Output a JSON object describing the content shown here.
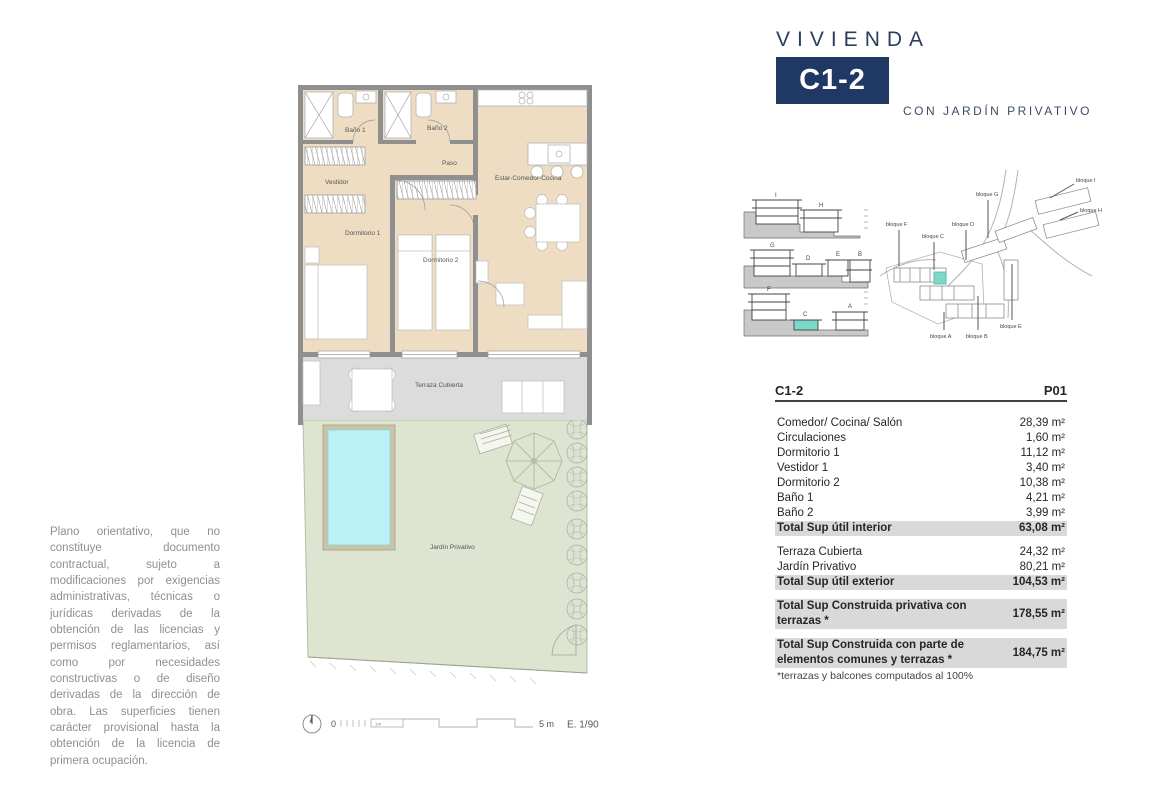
{
  "header": {
    "title": "VIVIENDA",
    "unit_code": "C1-2",
    "subtitle": "CON JARDÍN PRIVATIVO",
    "accent_color": "#1f3864"
  },
  "disclaimer": "Plano orientativo, que no constituye documento contractual, sujeto a modificaciones por exigencias administrativas, técnicas o jurídicas derivadas de la obtención de las licencias y permisos reglamentarios, así como por necesidades constructivas o de diseño derivadas de la dirección de obra. Las superficies tienen carácter provisional hasta la obtención de la licencia de primera ocupación.",
  "floorplan": {
    "labels": {
      "bano1": "Baño 1",
      "bano2": "Baño 2",
      "paso": "Paso",
      "vestidor": "Vestidor",
      "dormitorio1": "Dormitorio 1",
      "dormitorio2": "Dormitorio 2",
      "estar": "Estar-Comedor-Cocina",
      "terraza": "Terraza Cubierta",
      "jardin": "Jardín Privativo"
    },
    "colors": {
      "interior": "#eeddc2",
      "wall": "#8f8f8f",
      "terrace": "#dcdcdc",
      "garden": "#dde4d0",
      "pool": "#baf1f6",
      "highlight": "#7cd8c8"
    }
  },
  "scalebar": {
    "zero": "0",
    "one_m": "1m",
    "five_m": "5 m",
    "scale": "E. 1/90"
  },
  "sections": {
    "rows": [
      {
        "blocks": [
          "I",
          "H"
        ]
      },
      {
        "blocks": [
          "G",
          "D",
          "E",
          "B"
        ]
      },
      {
        "blocks": [
          "F",
          "C",
          "A"
        ]
      }
    ]
  },
  "siteplan": {
    "labels": [
      "bloque F",
      "bloque C",
      "bloque G",
      "bloque D",
      "bloque I",
      "bloque H",
      "bloque A",
      "bloque B",
      "bloque E"
    ]
  },
  "table": {
    "unit": "C1-2",
    "floor": "P01",
    "groups": [
      {
        "items": [
          {
            "label": "Comedor/ Cocina/ Salón",
            "value": "28,39 m²"
          },
          {
            "label": "Circulaciones",
            "value": "1,60 m²"
          },
          {
            "label": "Dormitorio 1",
            "value": "11,12 m²"
          },
          {
            "label": "Vestidor 1",
            "value": "3,40 m²"
          },
          {
            "label": "Dormitorio 2",
            "value": "10,38 m²"
          },
          {
            "label": "Baño 1",
            "value": "4,21 m²"
          },
          {
            "label": "Baño 2",
            "value": "3,99 m²"
          }
        ],
        "total": {
          "label": "Total Sup útil interior",
          "value": "63,08 m²"
        }
      },
      {
        "items": [
          {
            "label": "Terraza Cubierta",
            "value": "24,32 m²"
          },
          {
            "label": "Jardín Privativo",
            "value": "80,21 m²"
          }
        ],
        "total": {
          "label": "Total Sup útil exterior",
          "value": "104,53 m²"
        }
      },
      {
        "items": [],
        "total": {
          "label": "Total Sup Construida privativa con terrazas *",
          "value": "178,55 m²"
        }
      },
      {
        "items": [],
        "total": {
          "label": "Total Sup Construida con parte de elementos comunes y terrazas *",
          "value": "184,75 m²"
        }
      }
    ],
    "note": "*terrazas y balcones computados al 100%"
  }
}
